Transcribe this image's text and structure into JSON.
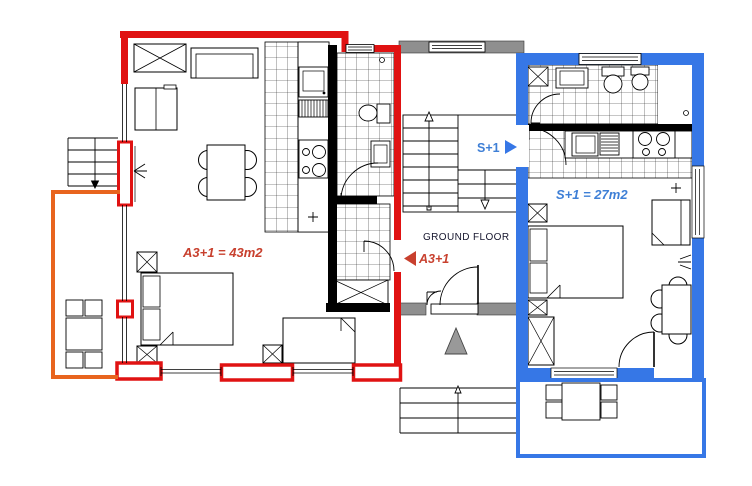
{
  "plan": {
    "floor_label": "GROUND FLOOR",
    "apartment_a3": {
      "name": "A3+1",
      "area_label": "A3+1 = 43m2",
      "pointer_label": "A3+1",
      "wall_color": "#E01212",
      "text_color": "#C8402E",
      "terrace_color": "#E8641E"
    },
    "apartment_s1": {
      "name": "S+1",
      "area_label": "S+1 = 27m2",
      "pointer_label": "S+1",
      "wall_color": "#3677E6",
      "text_color": "#3E7FD6"
    },
    "colors": {
      "gray_wall": "#8F8F8F",
      "interior_wall": "#000000",
      "line": "#000000",
      "text_dark": "#16162E"
    }
  }
}
